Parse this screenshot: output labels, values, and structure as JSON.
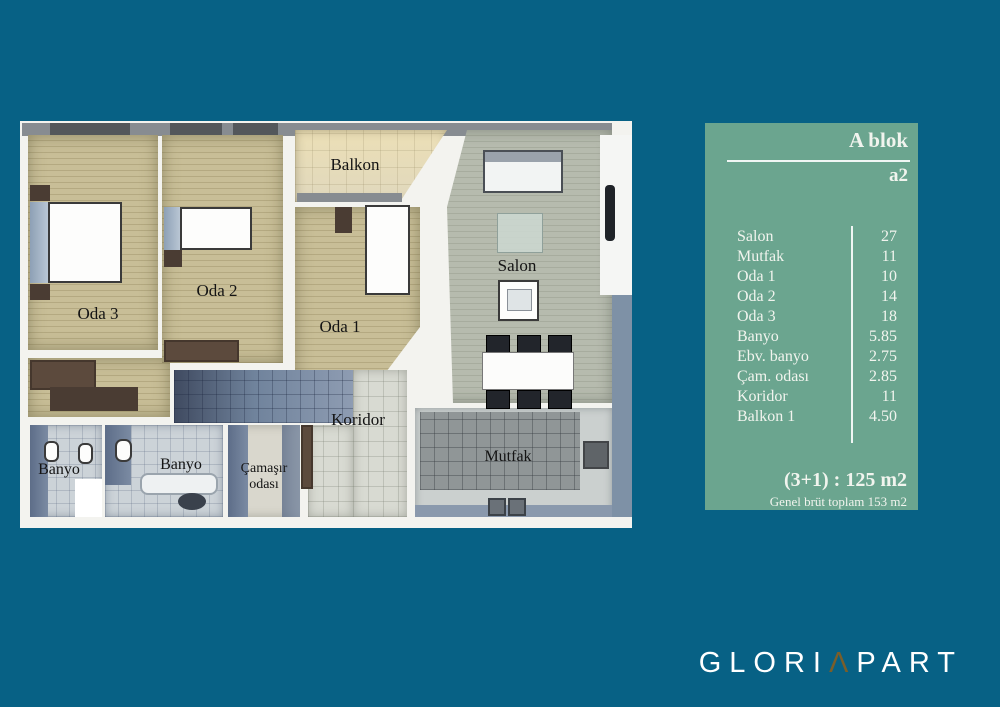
{
  "background_color": "#076185",
  "floor_plan": {
    "labels": {
      "balkon": "Balkon",
      "oda1": "Oda 1",
      "oda2": "Oda 2",
      "oda3": "Oda 3",
      "salon": "Salon",
      "koridor": "Koridor",
      "banyo_small": "Banyo",
      "banyo_main": "Banyo",
      "camasir_line1": "Çamaşır",
      "camasir_line2": "odası",
      "mutfak": "Mutfak"
    }
  },
  "info_panel": {
    "panel_color": "#6BA58F",
    "block_title": "A blok",
    "unit_title": "a2",
    "rooms": [
      {
        "label": "Salon",
        "area": "27"
      },
      {
        "label": "Mutfak",
        "area": "11"
      },
      {
        "label": "Oda 1",
        "area": "10"
      },
      {
        "label": "Oda 2",
        "area": "14"
      },
      {
        "label": "Oda 3",
        "area": "18"
      },
      {
        "label": "Banyo",
        "area": "5.85"
      },
      {
        "label": "Ebv. banyo",
        "area": "2.75"
      },
      {
        "label": "Çam. odası",
        "area": "2.85"
      },
      {
        "label": "Koridor",
        "area": "11"
      },
      {
        "label": "Balkon 1",
        "area": "4.50"
      }
    ],
    "summary": "(3+1) : 125 m2",
    "summary_note": "Genel brüt toplam 153 m2"
  },
  "logo": {
    "part1": "GLORI",
    "accent": "Λ",
    "part2": "PART",
    "accent_color": "#7A5E2A"
  }
}
